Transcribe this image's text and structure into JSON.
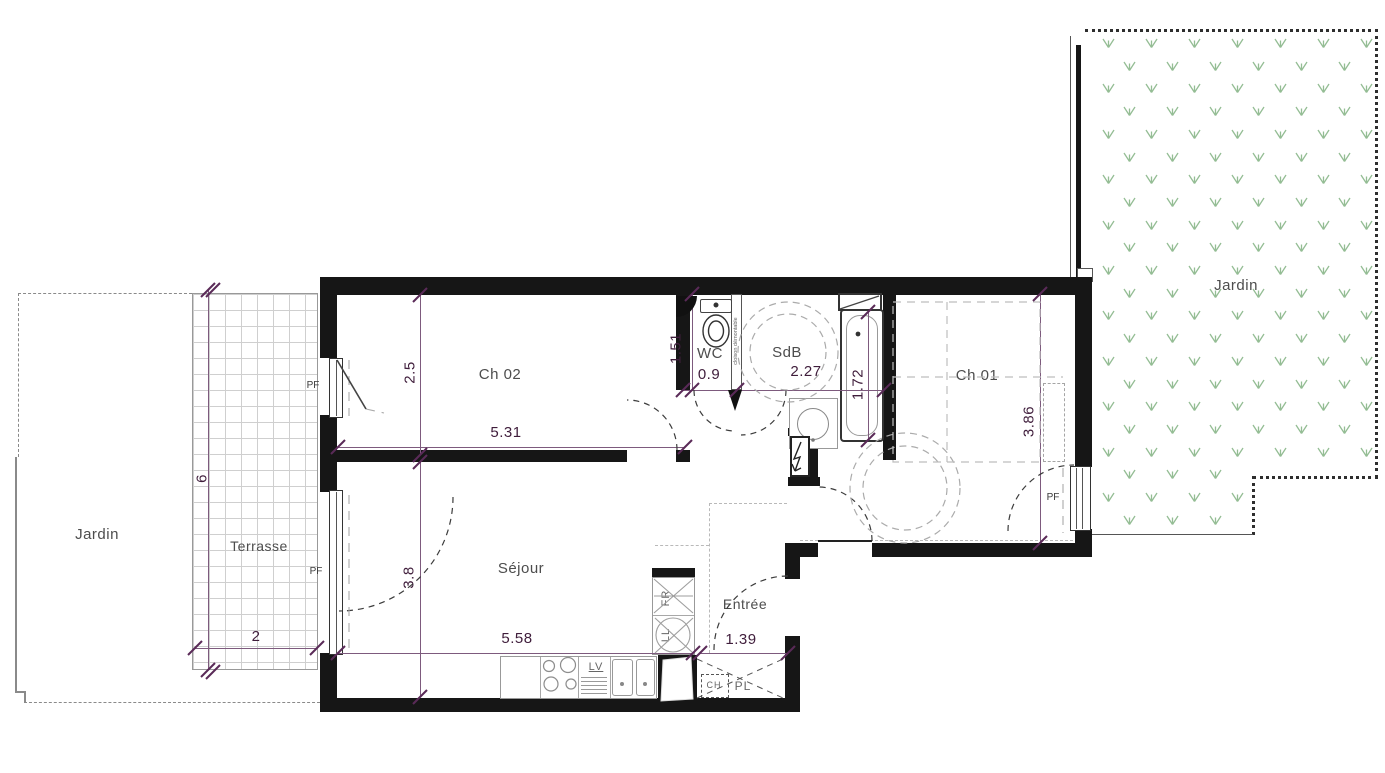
{
  "colors": {
    "wall": "#161616",
    "dimension": "#3f1d3b",
    "dimension_line": "#7d5a7d",
    "room_label": "#4d4d4d",
    "fixture": "#999999",
    "grass": "#94bd94",
    "boundary": "#8a8a8a"
  },
  "rooms": {
    "ch02": {
      "label": "Ch 02"
    },
    "wc": {
      "label": "WC"
    },
    "sdb": {
      "label": "SdB"
    },
    "ch01": {
      "label": "Ch 01"
    },
    "sejour": {
      "label": "Séjour"
    },
    "entree": {
      "label": "Entrée"
    },
    "terrasse": {
      "label": "Terrasse"
    },
    "jardin_left": {
      "label": "Jardin"
    },
    "jardin_right": {
      "label": "Jardin"
    }
  },
  "dimensions": {
    "ch02_width": "2.5",
    "ch02_length": "5.31",
    "wc_depth": "1.51",
    "wc_width": "0.9",
    "sdb_width": "2.27",
    "bath_length": "1.72",
    "ch01_depth": "3.86",
    "sejour_depth": "3.8",
    "sejour_length": "5.58",
    "entree_width": "1.39",
    "terrasse_depth": "6",
    "terrasse_width": "2"
  },
  "annotations": {
    "pf": "PF",
    "fr": "FR",
    "ll": "LL",
    "lv": "LV",
    "ch": "CH",
    "pl": "PL",
    "cloison": "cloison démontable"
  }
}
